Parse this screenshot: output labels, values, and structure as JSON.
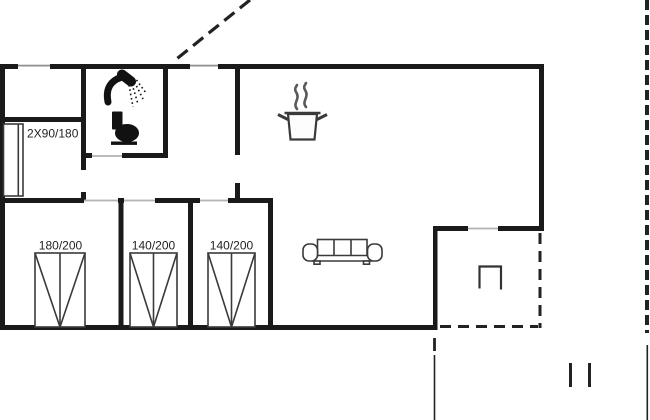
{
  "plan": {
    "type": "holiday-house-floor-plan",
    "labels": {
      "bunk_bed": "2X90/180",
      "bed_1": "180/200",
      "bed_2": "140/200",
      "bed_3": "140/200"
    },
    "icons": [
      "shower-icon",
      "toilet-icon",
      "cooking-pot-icon",
      "sofa-icon",
      "terrace-furniture-icon"
    ],
    "colors": {
      "wall": "#1a1a1a",
      "furniture_line": "#3a3a3a",
      "door_opening": "#b4b4b4",
      "window": "#909090",
      "background": "#ffffff"
    }
  }
}
